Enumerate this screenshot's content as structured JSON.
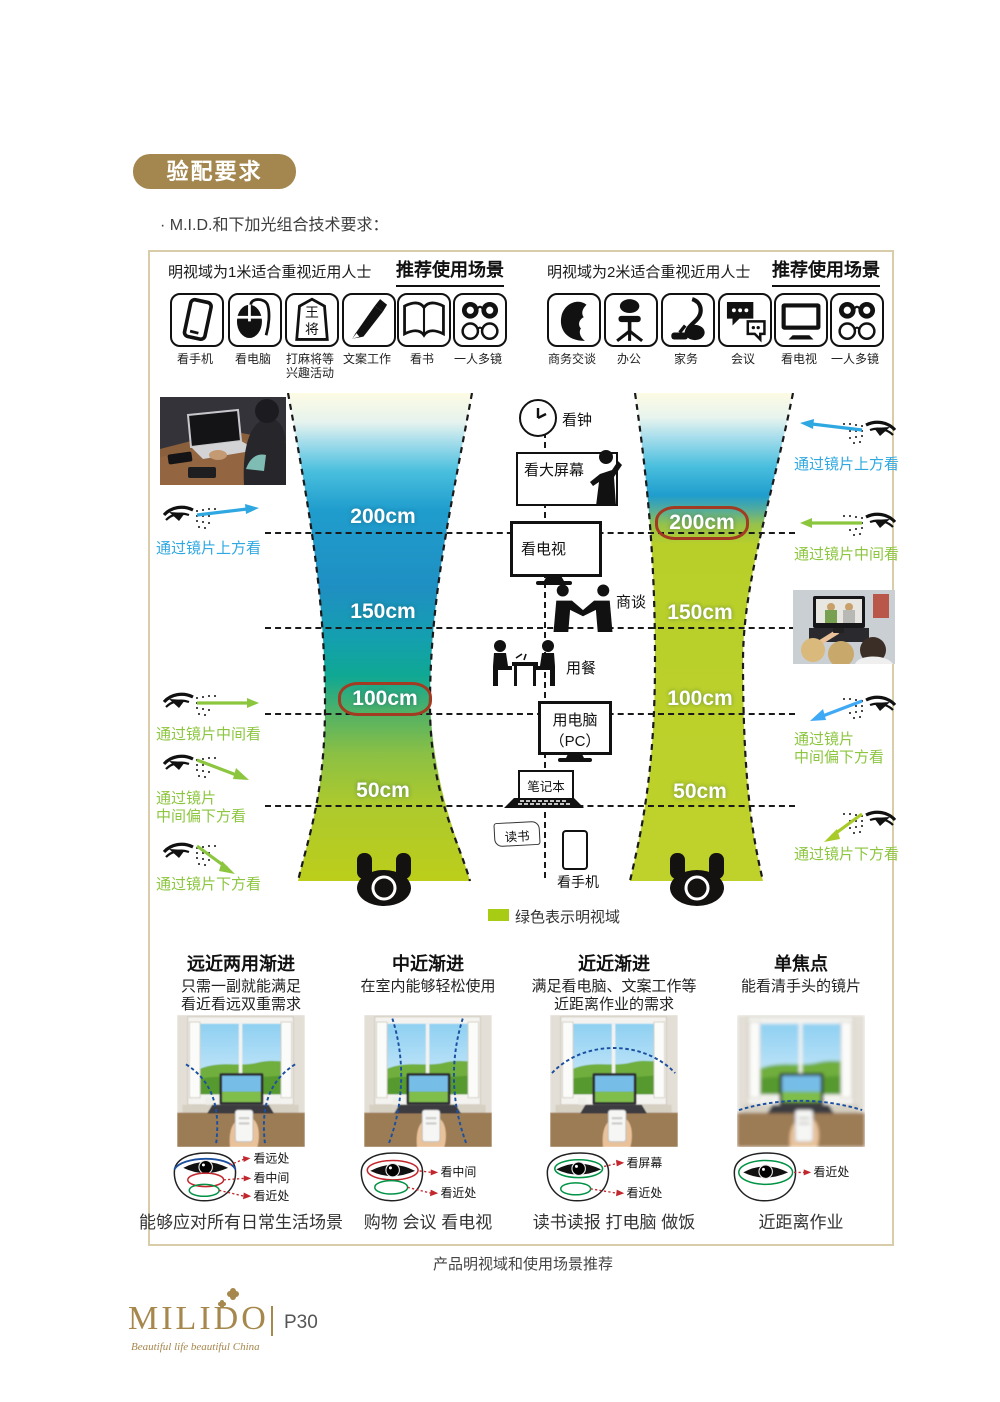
{
  "header": {
    "badge": "验配要求",
    "subtitle": "· M.I.D.和下加光组合技术要求："
  },
  "panels": {
    "left": {
      "title": "明视域为1米适合重视近用人士",
      "scenes_title": "推荐使用场景",
      "icons": [
        {
          "name": "phone-icon",
          "label": "看手机"
        },
        {
          "name": "mouse-icon",
          "label": "看电脑"
        },
        {
          "name": "shogi-icon",
          "label": "打麻将等",
          "label2": "兴趣活动",
          "glyph1": "王",
          "glyph2": "将"
        },
        {
          "name": "pen-icon",
          "label": "文案工作"
        },
        {
          "name": "book-icon",
          "label": "看书"
        },
        {
          "name": "glasses-icon",
          "label": "一人多镜"
        }
      ]
    },
    "right": {
      "title": "明视域为2米适合重视近用人士",
      "scenes_title": "推荐使用场景",
      "icons": [
        {
          "name": "profile-icon",
          "label": "商务交谈"
        },
        {
          "name": "chair-icon",
          "label": "办公"
        },
        {
          "name": "vacuum-icon",
          "label": "家务"
        },
        {
          "name": "chat-icon",
          "label": "会议"
        },
        {
          "name": "tv-icon",
          "label": "看电视"
        },
        {
          "name": "glasses-icon",
          "label": "一人多镜"
        }
      ]
    }
  },
  "diagram": {
    "left_distances": [
      {
        "label": "200cm"
      },
      {
        "label": "150cm"
      },
      {
        "label": "100cm",
        "circled": true
      },
      {
        "label": "50cm"
      }
    ],
    "right_distances": [
      {
        "label": "200cm",
        "circled": true
      },
      {
        "label": "150cm"
      },
      {
        "label": "100cm"
      },
      {
        "label": "50cm"
      }
    ],
    "center": {
      "clock": "看钟",
      "big_screen": "看大屏幕",
      "tv": "看电视",
      "negotiate": "商谈",
      "dining": "用餐",
      "pc1": "用电脑",
      "pc2": "（PC）",
      "laptop": "笔记本",
      "reading": "读书",
      "phone": "看手机"
    },
    "legend": "绿色表示明视域",
    "left_annotations": [
      {
        "line1": "通过镜片上方看",
        "line2": ""
      },
      {
        "line1": "通过镜片中间看",
        "line2": ""
      },
      {
        "line1": "通过镜片",
        "line2": "中间偏下方看"
      },
      {
        "line1": "通过镜片下方看",
        "line2": ""
      }
    ],
    "right_annotations": [
      {
        "line1": "通过镜片上方看",
        "line2": ""
      },
      {
        "line1": "通过镜片中间看",
        "line2": ""
      },
      {
        "line1": "通过镜片",
        "line2": "中间偏下方看"
      },
      {
        "line1": "通过镜片下方看",
        "line2": ""
      }
    ]
  },
  "lens_types": [
    {
      "title": "远近两用渐进",
      "desc1": "只需一副就能满足",
      "desc2": "看近看远双重需求",
      "zone1": "看远处",
      "zone2": "看中间",
      "zone3": "看近处",
      "caption": "能够应对所有日常生活场景"
    },
    {
      "title": "中近渐进",
      "desc1": "在室内能够轻松使用",
      "desc2": "",
      "zone1": "看中间",
      "zone2": "看近处",
      "zone3": "",
      "caption": "购物 会议 看电视"
    },
    {
      "title": "近近渐进",
      "desc1": "满足看电脑、文案工作等",
      "desc2": "近距离作业的需求",
      "zone1": "看屏幕",
      "zone2": "看近处",
      "zone3": "",
      "caption": "读书读报 打电脑 做饭"
    },
    {
      "title": "单焦点",
      "desc1": "能看清手头的镜片",
      "desc2": "",
      "zone1": "看近处",
      "zone2": "",
      "zone3": "",
      "caption": "近距离作业"
    }
  ],
  "footer": {
    "caption": "产品明视域和使用场景推荐",
    "brand": "MILIDO",
    "tagline": "Beautiful life beautiful China",
    "page": "P30"
  },
  "colors": {
    "gold": "#A3874E",
    "blue": "#2FA8E1",
    "green": "#8CC63F",
    "legend_green": "#A8CC14",
    "red_ring": "#A23B22"
  }
}
